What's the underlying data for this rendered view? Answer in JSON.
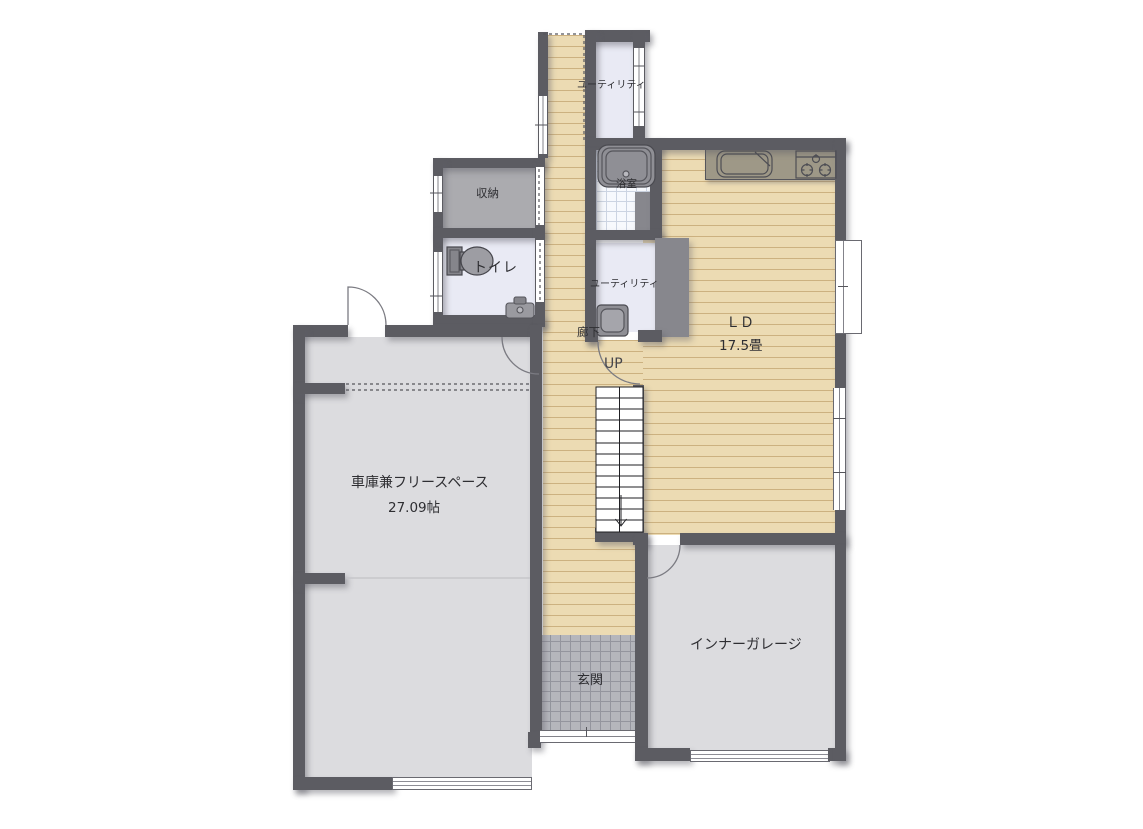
{
  "diagram_type": "floor-plan",
  "rooms": {
    "utility_top": {
      "label": "ユーティリティ"
    },
    "storage": {
      "label": "収納"
    },
    "bathroom": {
      "label": "浴室"
    },
    "toilet": {
      "label": "トイレ"
    },
    "utility_low": {
      "label": "ユーティリティ"
    },
    "hallway": {
      "label": "廊下"
    },
    "stairs": {
      "label": "UP"
    },
    "living_dining": {
      "label": "ＬＤ",
      "area": "17.5畳"
    },
    "garage_free_space": {
      "label": "車庫兼フリースペース",
      "area": "27.09帖"
    },
    "inner_garage": {
      "label": "インナーガレージ"
    },
    "entrance": {
      "label": "玄関"
    }
  },
  "colors": {
    "wall": "#5c5c62",
    "wood_floor": "#ecdbb3",
    "gray_room": "#dcdcdf",
    "storage_fill": "#ababaf",
    "white_room": "#e9eaf4",
    "bath_tile_line": "#ccd4e2",
    "entrance_tile": "#b5b6bc",
    "kitchen_counter": "#9e9887"
  }
}
